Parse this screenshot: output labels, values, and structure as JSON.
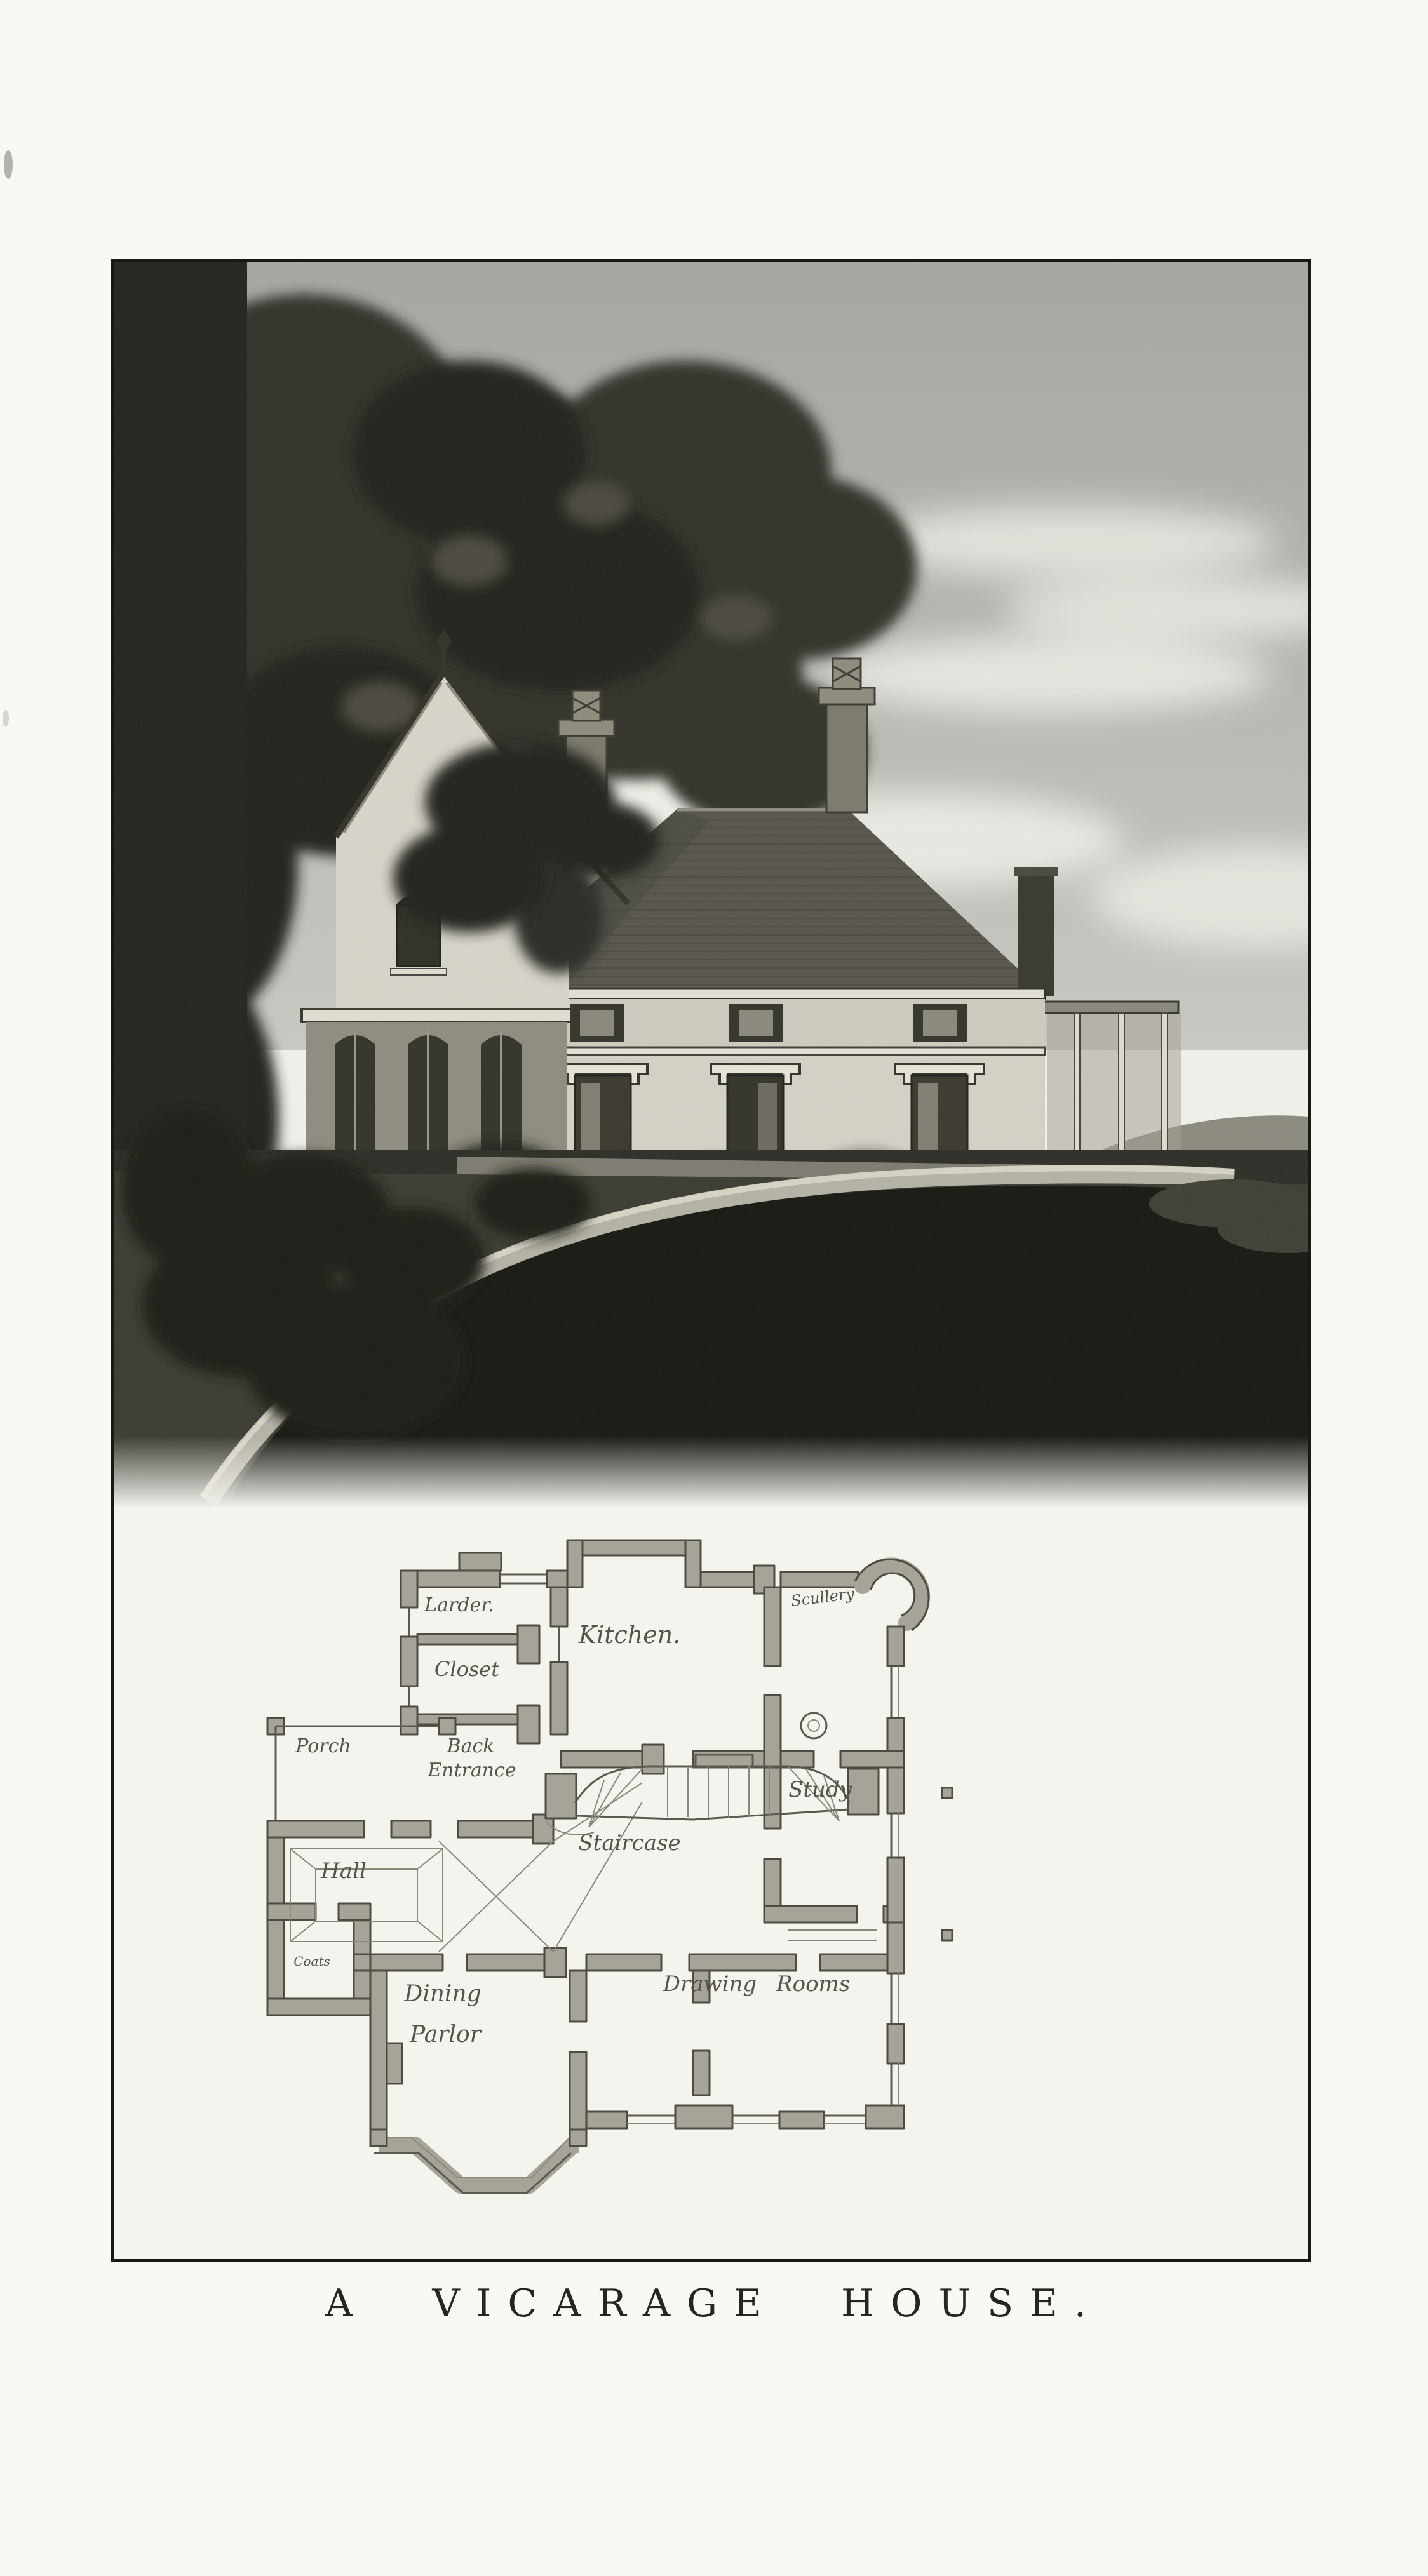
{
  "plate": {
    "caption": "A VICARAGE HOUSE."
  },
  "plan": {
    "rooms": {
      "larder": "Larder.",
      "closet": "Closet",
      "kitchen": "Kitchen.",
      "scullery": "Scullery",
      "porch": "Porch",
      "back_entrance_1": "Back",
      "back_entrance_2": "Entrance",
      "study": "Study",
      "hall": "Hall",
      "staircase": "Staircase",
      "coats": "Coats",
      "dining_1": "Dining",
      "dining_2": "Parlor",
      "drawing_rooms": "Drawing Rooms"
    }
  }
}
